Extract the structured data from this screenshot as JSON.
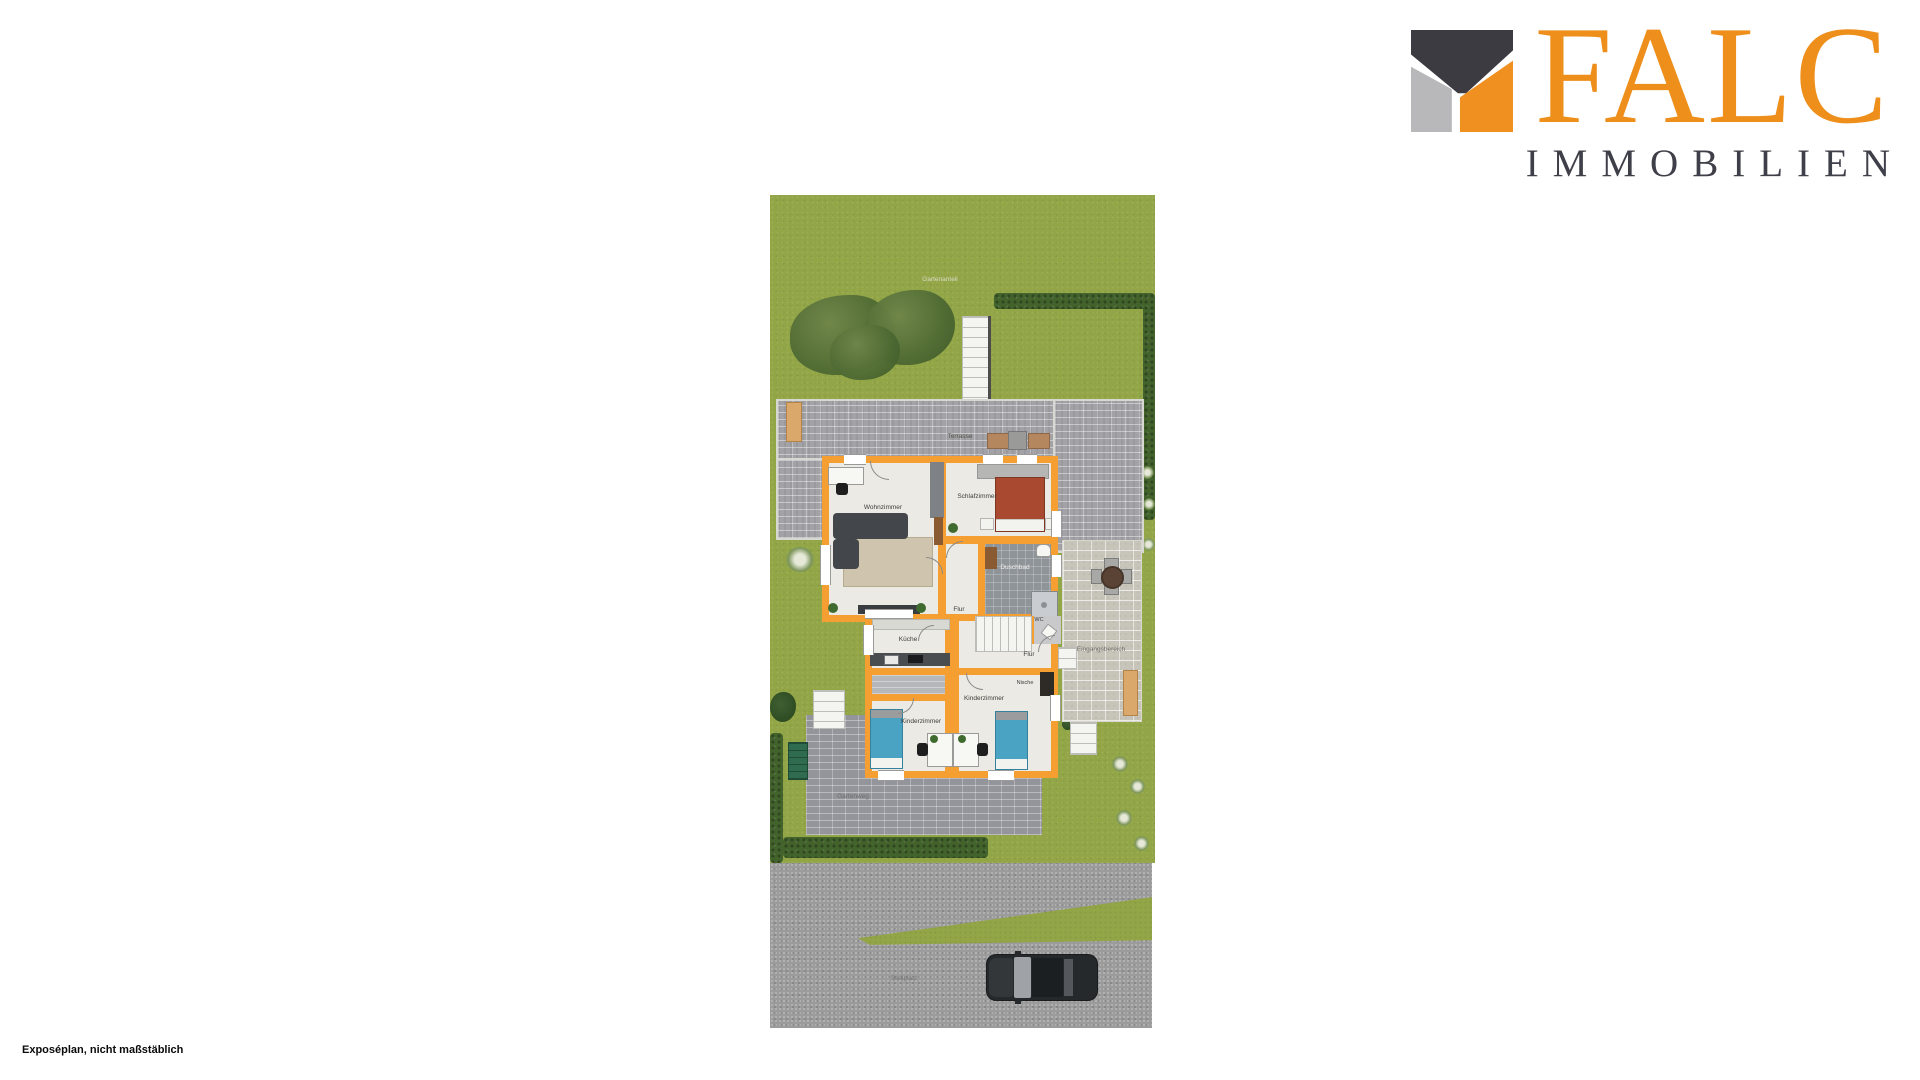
{
  "logo": {
    "brand": "FALC",
    "subtitle": "IMMOBILIEN",
    "mark_colors": {
      "dark": "#3b3b41",
      "gray": "#b8b8ba",
      "orange": "#ef9021"
    }
  },
  "plan": {
    "room_labels": [
      {
        "text": "Wohnzimmer"
      },
      {
        "text": "Schlafzimmer"
      },
      {
        "text": "Duschbad"
      },
      {
        "text": "Flur"
      },
      {
        "text": "WC"
      },
      {
        "text": "Küche"
      },
      {
        "text": "Flur"
      },
      {
        "text": "Nische"
      },
      {
        "text": "Kinderzimmer"
      },
      {
        "text": "Kinderzimmer"
      }
    ],
    "outdoor_labels": [
      {
        "text": "Gartenanteil"
      },
      {
        "text": "Terrasse"
      },
      {
        "text": "Eingangsbereich"
      },
      {
        "text": "Gartenweg"
      },
      {
        "text": "Stellplatz"
      }
    ],
    "colors": {
      "wall": "#f59f33",
      "lawn": "#93a647",
      "hedge": "#43632c",
      "terrace": "#a2a2a7",
      "stone_patio": "#c7c4b9",
      "driveway": "#9b9b9b",
      "bed_master": "#a9492f",
      "bed_kids": "#4ba3c4"
    }
  },
  "footer": {
    "note": "Exposéplan, nicht maßstäblich"
  }
}
